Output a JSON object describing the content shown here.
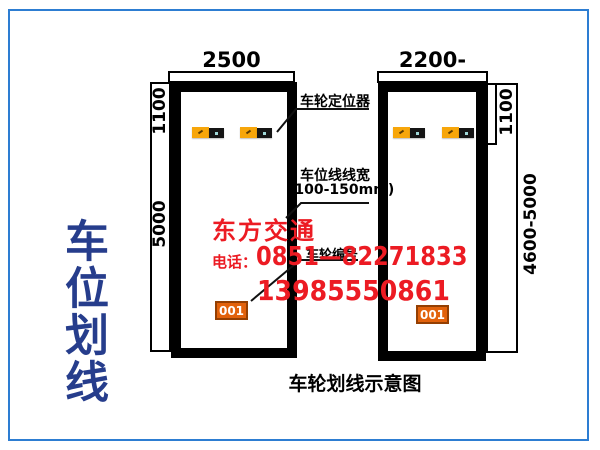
{
  "page": {
    "side_title": "车位划线",
    "caption": "车轮划线示意图"
  },
  "colors": {
    "frame_blue": "#2d7dd2",
    "title_blue": "#263d8c",
    "watermark_red": "#ec1b23",
    "positioner_orange": "#f7a60a",
    "positioner_black": "#151515",
    "tag_orange": "#e2620c"
  },
  "left_stall": {
    "width_label": "2500",
    "upper_depth_label": "1100",
    "full_depth_label": "5000",
    "tag": "001"
  },
  "right_stall": {
    "width_label": "2200-2300",
    "upper_depth_label": "1100",
    "full_depth_label": "4600-5000",
    "tag": "001"
  },
  "annotations": {
    "wheel_positioner": "车轮定位器",
    "line_width_line1": "车位线线宽",
    "line_width_line2": "(100-150mm)",
    "stall_number": "车轮编号"
  },
  "watermark": {
    "company": "东方交通",
    "phone_prefix": "电话：",
    "phone1": "0851—82271833",
    "phone2": "13985550861"
  }
}
